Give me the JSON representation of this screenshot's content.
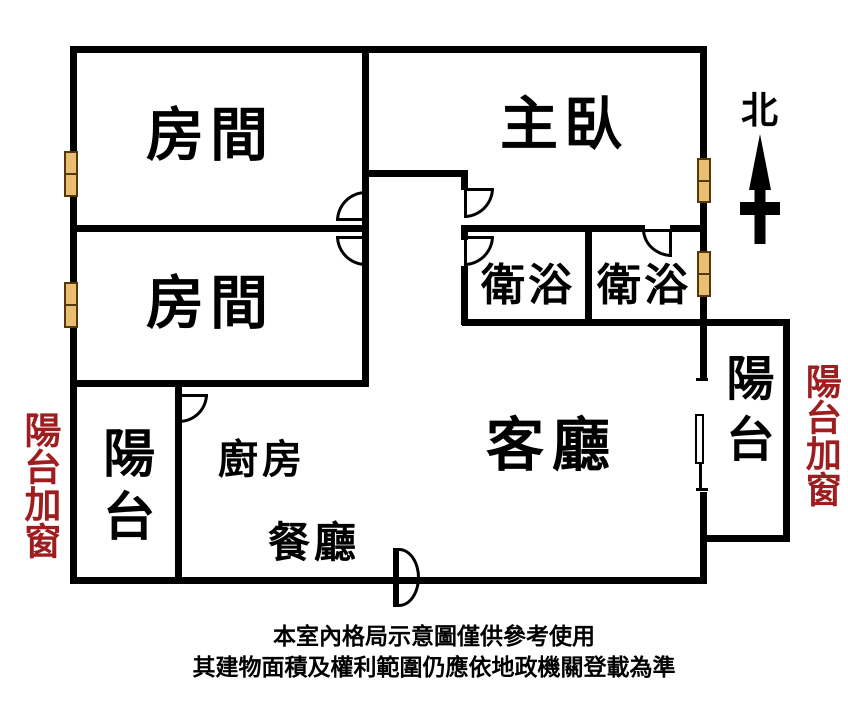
{
  "colors": {
    "wall": "#000000",
    "window_fill": "#E9BD72",
    "window_border": "#54380A",
    "accent_red": "#9E1E20",
    "background": "#FFFFFF"
  },
  "rooms": {
    "bedroom_top": {
      "label": "房間"
    },
    "bedroom_mid": {
      "label": "房間"
    },
    "master": {
      "label": "主臥"
    },
    "bath_left": {
      "label": "衛浴"
    },
    "bath_right": {
      "label": "衛浴"
    },
    "balcony_left": {
      "label": "陽台"
    },
    "kitchen": {
      "label": "廚房"
    },
    "dining": {
      "label": "餐廳"
    },
    "living": {
      "label": "客廳"
    },
    "balcony_right": {
      "label": "陽台"
    }
  },
  "annotations": {
    "north": {
      "label": "北"
    },
    "balcony_note_left": {
      "label": "陽台加窗"
    },
    "balcony_note_right": {
      "label": "陽台加窗"
    },
    "disclaimer_line1": "本室內格局示意圖僅供參考使用",
    "disclaimer_line2": "其建物面積及權利範圍仍應依地政機關登載為準"
  }
}
